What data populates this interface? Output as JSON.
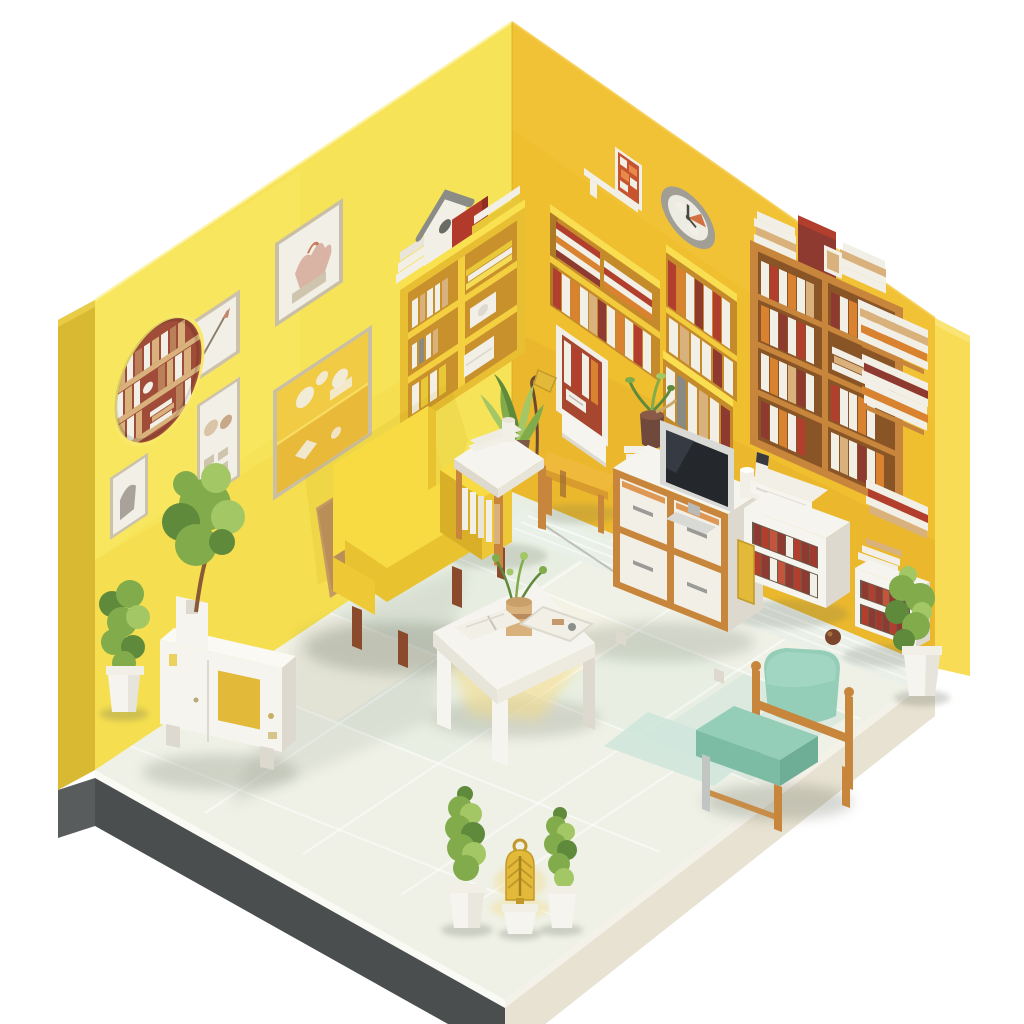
{
  "scene": {
    "title": "Isometric 3D illustration of a cozy yellow reading room",
    "style": "low-poly isometric render, no visible text"
  },
  "palette": {
    "background": "#FFFFFF",
    "wall_left": "#F7E357",
    "wall_left_side": "#D9B832",
    "wall_right": "#EFBF30",
    "wall_right_band": "#F8DC55",
    "niche_back": "#C58B2B",
    "niche_lintel": "#F9DE52",
    "floor": "#EFF1E6",
    "tile_green": "#E1ECDE",
    "tile_cream": "#F5F3E3",
    "tile_teal": "#CFE5DB",
    "plinth_dark": "#4B4E4E",
    "plinth_light": "#E7E2D2",
    "white_furniture": "#F5F4EE",
    "white_shade": "#DDD9CE",
    "wood": "#C8853C",
    "wood_dark": "#9C6A30",
    "wood_leg": "#8B4A2C",
    "armchair_yellow": "#F8DB42",
    "armchair_yellow_dark": "#E9C32F",
    "armchair_yellow_light": "#FBE968",
    "teal_chair": "#95CEB8",
    "teal_chair_dark": "#7CBCA4",
    "leaf": "#82AC4B",
    "leaf_dark": "#5F8A3C",
    "leaf_light": "#A4C766",
    "book_red": "#B23F2E",
    "book_maroon": "#8E3A30",
    "book_orange": "#D9822F",
    "book_tan": "#D9B17C",
    "book_white": "#F2EFE7",
    "gold": "#E3B93A",
    "gold_dark": "#C1992A",
    "clock_rim": "#A09E95",
    "clock_face": "#EDECE3",
    "accent_orange": "#CE6430",
    "porthole_back": "#A04C38",
    "tv_screen": "#24272B",
    "tv_frame": "#D9D9D5",
    "shadow": "#5F6654"
  },
  "objects": {
    "room": "isometric yellow room with two walls and tiled floor",
    "left_wall": "bright yellow left wall with gallery picture frames",
    "right_wall": "golden yellow right wall with recessed book niches",
    "floor": "pale tiled floor with soft shadows",
    "plinth": "dark and light floor base edges",
    "gallery_frames": "six framed sketches and prints",
    "porthole": "round wall opening showing a bookshelf",
    "wall_shelf": "yellow wall-mounted shelf with books, birdhouse and red box",
    "yellow_armchair": "yellow upholstered armchair with wooden legs",
    "leaning_board": "tan board leaning behind the armchair",
    "side_table": "white side table with magazines and books",
    "corner_plant": "leafy potted plant in the corner",
    "floor_lamp": "slim reading lamp with gold shade",
    "desk_bench": "yellow wooden bench below a white wall panel",
    "framed_books": "wall frame displaying book spines",
    "wall_clock": "round wall clock with grey rim",
    "mini_frame": "small framed red abstract print with ledge",
    "book_niches": "recessed wall niches filled with books",
    "tv": "flat-screen television",
    "tv_cabinet": "white media cabinet with wood-framed drawers",
    "remote_set": "white speaker cup and remote control",
    "bookshelf": "tall wooden bookshelf full of books",
    "book_stacks": "stacks of books on and beside the shelf",
    "magazine_cabinet": "white cabinet with red magazine files",
    "book_stand": "small white book stand with red books",
    "potted_plant_right": "bushy potted plant by the right wall",
    "decor_ball": "small brown ball on the floor",
    "teal_armchair": "mint green armchair with wooden frame",
    "rug": "pale teal rug patch",
    "coffee_table": "white coffee table with plant, tray and open book",
    "sideboard": "white sideboard with amber door panel",
    "potted_tree": "small tree in a white planter on the sideboard",
    "potted_bush": "bushy plant in a white pot",
    "conifer_trees": "two potted conifer trees",
    "lantern": "glowing golden lantern in a white pot"
  }
}
